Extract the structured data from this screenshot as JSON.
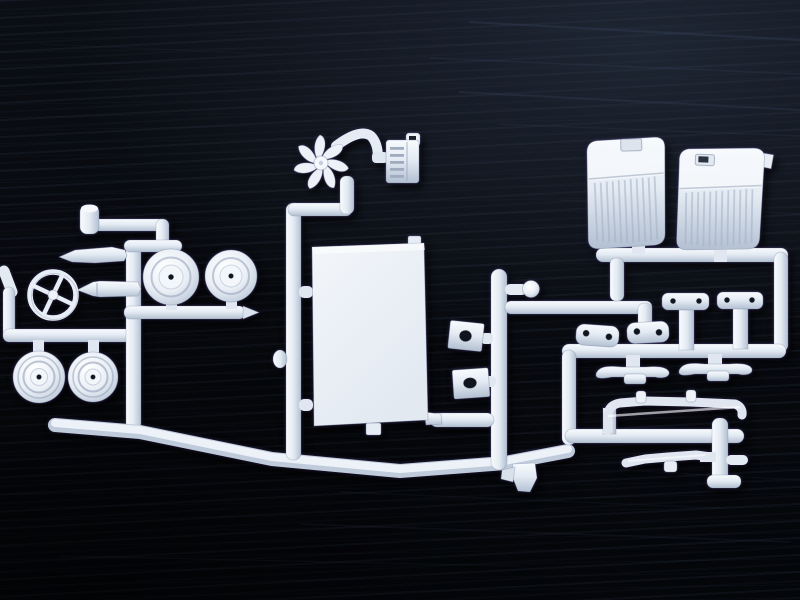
{
  "meta": {
    "title": "White model-kit parts sprue on black wooden table",
    "alt": "Photograph of a white injection-molded plastic model car sprue (parts tree) lying on a dark black wood-grain surface. No text is visible.",
    "media_type": "photograph"
  },
  "scene": {
    "colors": {
      "bg": "#07090e",
      "bg2": "#0b0e15",
      "grain": "#3d4a63",
      "plastic": "#e9eef5",
      "plasticHi": "#f8fbfe",
      "plasticMid": "#e4ebf3",
      "plasticLo": "#b3c0d2",
      "hole": "#10141c"
    },
    "surface": {
      "label": "black wooden tabletop with horizontal grain streaks"
    },
    "sprue": {
      "material": "white polystyrene, single parts tree, connected by round runners"
    },
    "parts": [
      {
        "id": "steering-wheel",
        "label": "four-spoke steering wheel",
        "count": 1
      },
      {
        "id": "steering-column",
        "label": "tapered steering column rod",
        "count": 1
      },
      {
        "id": "oil-filter",
        "label": "small upright cylinder part",
        "count": 1
      },
      {
        "id": "exhaust-pipe",
        "label": "tapered exhaust pipe",
        "count": 1
      },
      {
        "id": "front-wheels",
        "label": "smooth drum wheels with center hole",
        "count": 2
      },
      {
        "id": "rear-wheels",
        "label": "ringed wheels with hub caps",
        "count": 2
      },
      {
        "id": "radiator-fan",
        "label": "seven-blade cooling fan",
        "count": 1
      },
      {
        "id": "radiator",
        "label": "radiator with ribbed core and hook",
        "count": 1
      },
      {
        "id": "floor-panel",
        "label": "large flat rectangular body panel",
        "count": 1
      },
      {
        "id": "gear-knob",
        "label": "ball-ended shift lever stub",
        "count": 1
      },
      {
        "id": "firewall-plates",
        "label": "square plates with one center hole",
        "count": 2
      },
      {
        "id": "bench-seats",
        "label": "ribbed bucket seats, slotted tops",
        "count": 2
      },
      {
        "id": "shackle-plates",
        "label": "oval link plates with two holes",
        "count": 2
      },
      {
        "id": "t-brackets",
        "label": "T-shaped mounting brackets, two holes",
        "count": 2
      },
      {
        "id": "leaf-springs",
        "label": "leaf springs with center pad",
        "count": 2
      },
      {
        "id": "front-axle",
        "label": "front axle beam with perches",
        "count": 1
      },
      {
        "id": "rear-axle",
        "label": "rear axle / tie rod",
        "count": 1
      },
      {
        "id": "sprue-runners",
        "label": "round runner frame and gates",
        "count": 1
      }
    ]
  }
}
